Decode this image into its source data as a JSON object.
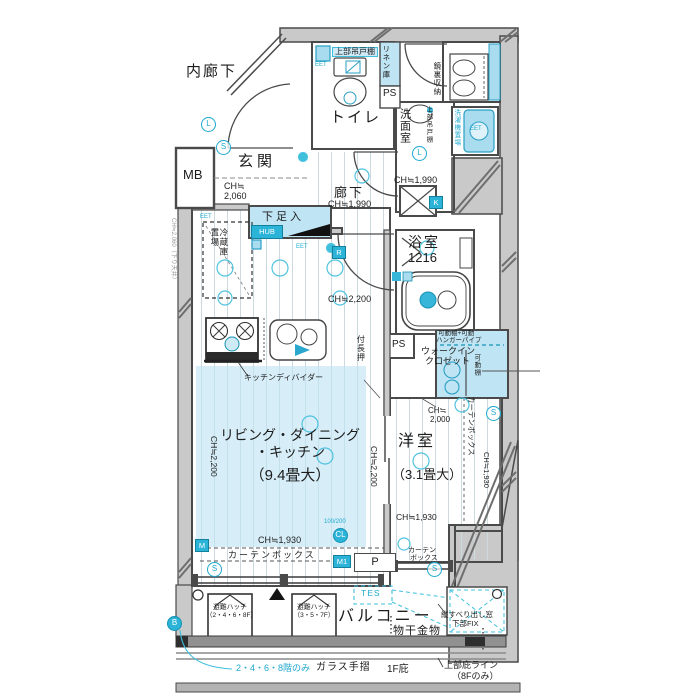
{
  "plan": {
    "common_area": {
      "inner_corridor": "内廊下",
      "mb": "MB"
    },
    "entrance": {
      "name": "玄関",
      "ch_1": "CH≒",
      "ch_2": "2,060",
      "shoe_box": "下足入",
      "hub": "HUB",
      "fridge_1": "冷蔵庫",
      "fridge_2": "置場",
      "eet": "EET"
    },
    "toilet": {
      "name": "トイレ",
      "upper_cupboard": "上部吊戸棚"
    },
    "washroom": {
      "name": "洗面室",
      "mirror_storage": "鏡裏収納",
      "upper_cupboard": "上部吊戸棚",
      "washer": "洗濯機置場",
      "linen": "リネン庫",
      "ps": "PS"
    },
    "hallway": {
      "name": "廊下",
      "ch": "CH≒1,990",
      "r": "R",
      "k": "K",
      "shaft_ch": "CH≒1,990"
    },
    "bath": {
      "name": "浴室",
      "size": "1216"
    },
    "kitchen": {
      "ch": "CH≒2,200",
      "divider": "キッチンディバイダー",
      "nageshi": "付長押",
      "ps": "PS"
    },
    "wic": {
      "shelf_note_1": "可動棚+可動",
      "shelf_note_2": "ハンガーパイプ",
      "name_1": "ウォークイン",
      "name_2": "クロゼット",
      "side_shelf": "可動棚"
    },
    "ldk": {
      "name_1": "リビング・ダイニング",
      "name_2": "・キッチン",
      "size": "（9.4畳大）",
      "ch_side": "CH≒2,200",
      "ch_window": "CH≒1,930",
      "curtain_box": "カーテンボックス",
      "cl_note": "100/200",
      "cl": "CL",
      "m": "M",
      "m1": "M1",
      "p": "P"
    },
    "western_room": {
      "name": "洋室",
      "size": "（3.1畳大）",
      "ch_1": "CH≒",
      "ch_2": "2,000",
      "ch_low": "CH≒1,930",
      "curtain_box": "カーテンボックス",
      "curtain_1": "カーテン",
      "curtain_2": "ボックス"
    },
    "balcony": {
      "name": "バルコニー",
      "hatch": "避難ハッチ",
      "hatch1_floors": "（2・4・6・8F）",
      "hatch2_floors": "（3・5・7F）",
      "tes": "TES",
      "laundry": "物干金物",
      "window_1": "縦すべり出し窓",
      "window_2": "下部FIX",
      "floors_note": "2・4・6・8階のみ",
      "glass_rail": "ガラス手摺",
      "f1_eave": "1F庇",
      "eave_line_1": "上部庇ライン",
      "eave_line_2": "（8Fのみ）",
      "b": "B"
    },
    "symbols": {
      "s": "S",
      "l": "L"
    },
    "wall_note": "CH≒2,060（下り天井）"
  },
  "colors": {
    "accent_cyan": "#1da9cf",
    "shade_blue": "#bfe4f3",
    "wall_gray": "#c9c9c9",
    "line_dark": "#4a4a4a"
  }
}
